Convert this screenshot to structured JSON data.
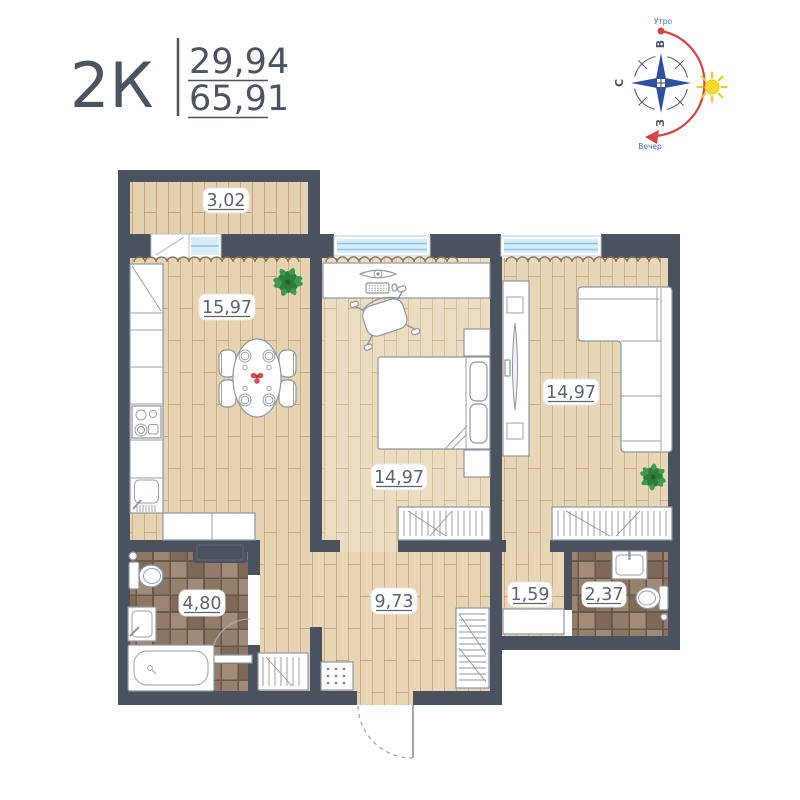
{
  "header": {
    "plan_type": "2К",
    "value_top": "29,94",
    "value_bottom": "65,91"
  },
  "compass": {
    "east": "В",
    "north": "С",
    "west": "З",
    "morning": "Утро",
    "evening": "Вечер"
  },
  "rooms": {
    "balcony": {
      "area": "3,02"
    },
    "kitchen": {
      "area": "15,97"
    },
    "bedroom": {
      "area": "14,97"
    },
    "living": {
      "area": "14,97"
    },
    "hall": {
      "area": "9,73"
    },
    "corridor": {
      "area": "1,59"
    },
    "wc": {
      "area": "2,37"
    },
    "bathroom": {
      "area": "4,80"
    }
  },
  "colors": {
    "ink": "#4c5462",
    "wall": "#4a5260",
    "compass-blue": "#2d4fa5",
    "sun-red": "#d64545",
    "sun-yellow": "#f8da2b",
    "wood": "#e6d3b1",
    "tile-brown": "#8d7767",
    "glass-blue": "#d9edf8"
  }
}
